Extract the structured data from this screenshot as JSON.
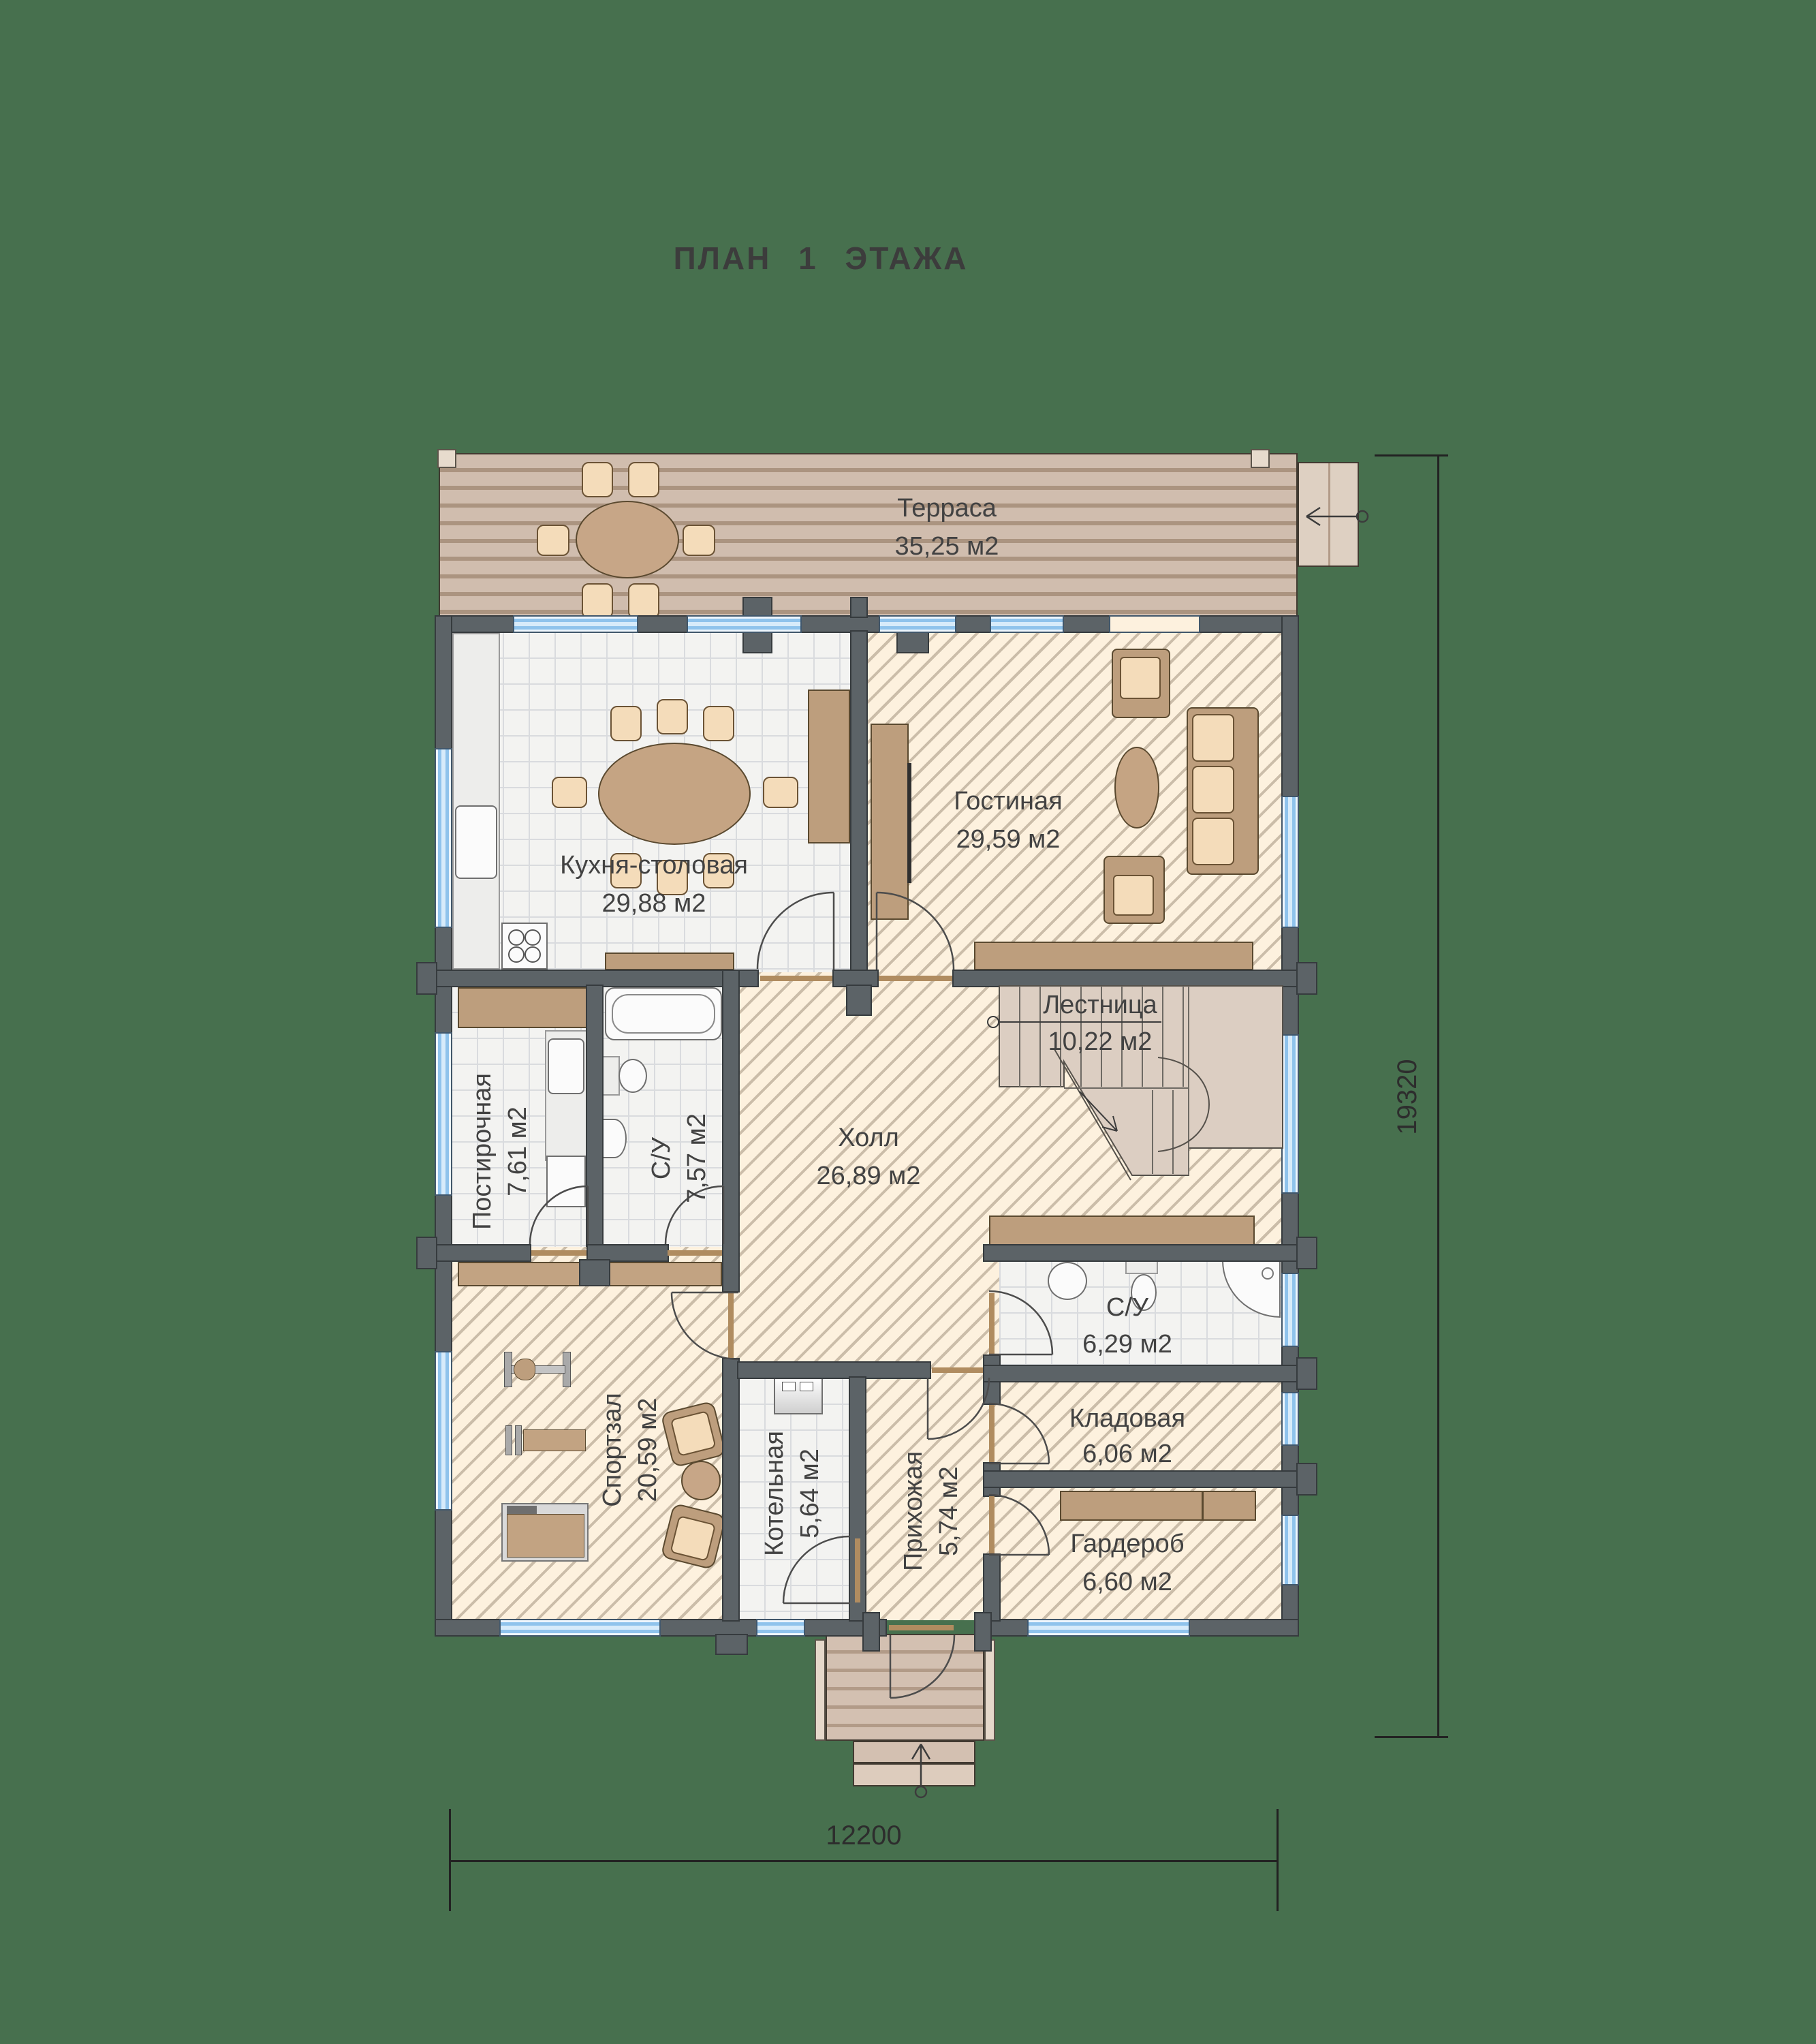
{
  "title": "ПЛАН  1  ЭТАЖА",
  "rooms": {
    "terrace": {
      "name": "Терраса",
      "area": "35,25  м2"
    },
    "kitchen": {
      "name": "Кухня-столовая",
      "area": "29,88  м2"
    },
    "living": {
      "name": "Гостиная",
      "area": "29,59  м2"
    },
    "stairs": {
      "name": "Лестница",
      "area": "10,22  м2"
    },
    "hall": {
      "name": "Холл",
      "area": "26,89  м2"
    },
    "laundry": {
      "name": "Постирочная",
      "area": "7,61  м2"
    },
    "bathroom_1": {
      "name": "С/У",
      "area": "7,57  м2"
    },
    "bathroom_2": {
      "name": "С/У",
      "area": "6,29  м2"
    },
    "gym": {
      "name": "Спортзал",
      "area": "20,59  м2"
    },
    "boiler": {
      "name": "Котельная",
      "area": "5,64  м2"
    },
    "entry": {
      "name": "Прихожая",
      "area": "5,74  м2"
    },
    "storage": {
      "name": "Кладовая",
      "area": "6,06  м2"
    },
    "wardrobe": {
      "name": "Гардероб",
      "area": "6,60  м2"
    }
  },
  "dimensions": {
    "overall_width": "12200",
    "overall_depth": "19320"
  },
  "colors": {
    "background": "#47704e",
    "wall": "#5c6367",
    "floor_cream": "#fdf1de",
    "hatch_line": "#cbbda9",
    "tile": "#f3f3f1",
    "deck": "#d0bdae",
    "window_blue": "#8fc3ec",
    "furniture_brown": "#bd9e7d",
    "furniture_light": "#f4dcba"
  }
}
